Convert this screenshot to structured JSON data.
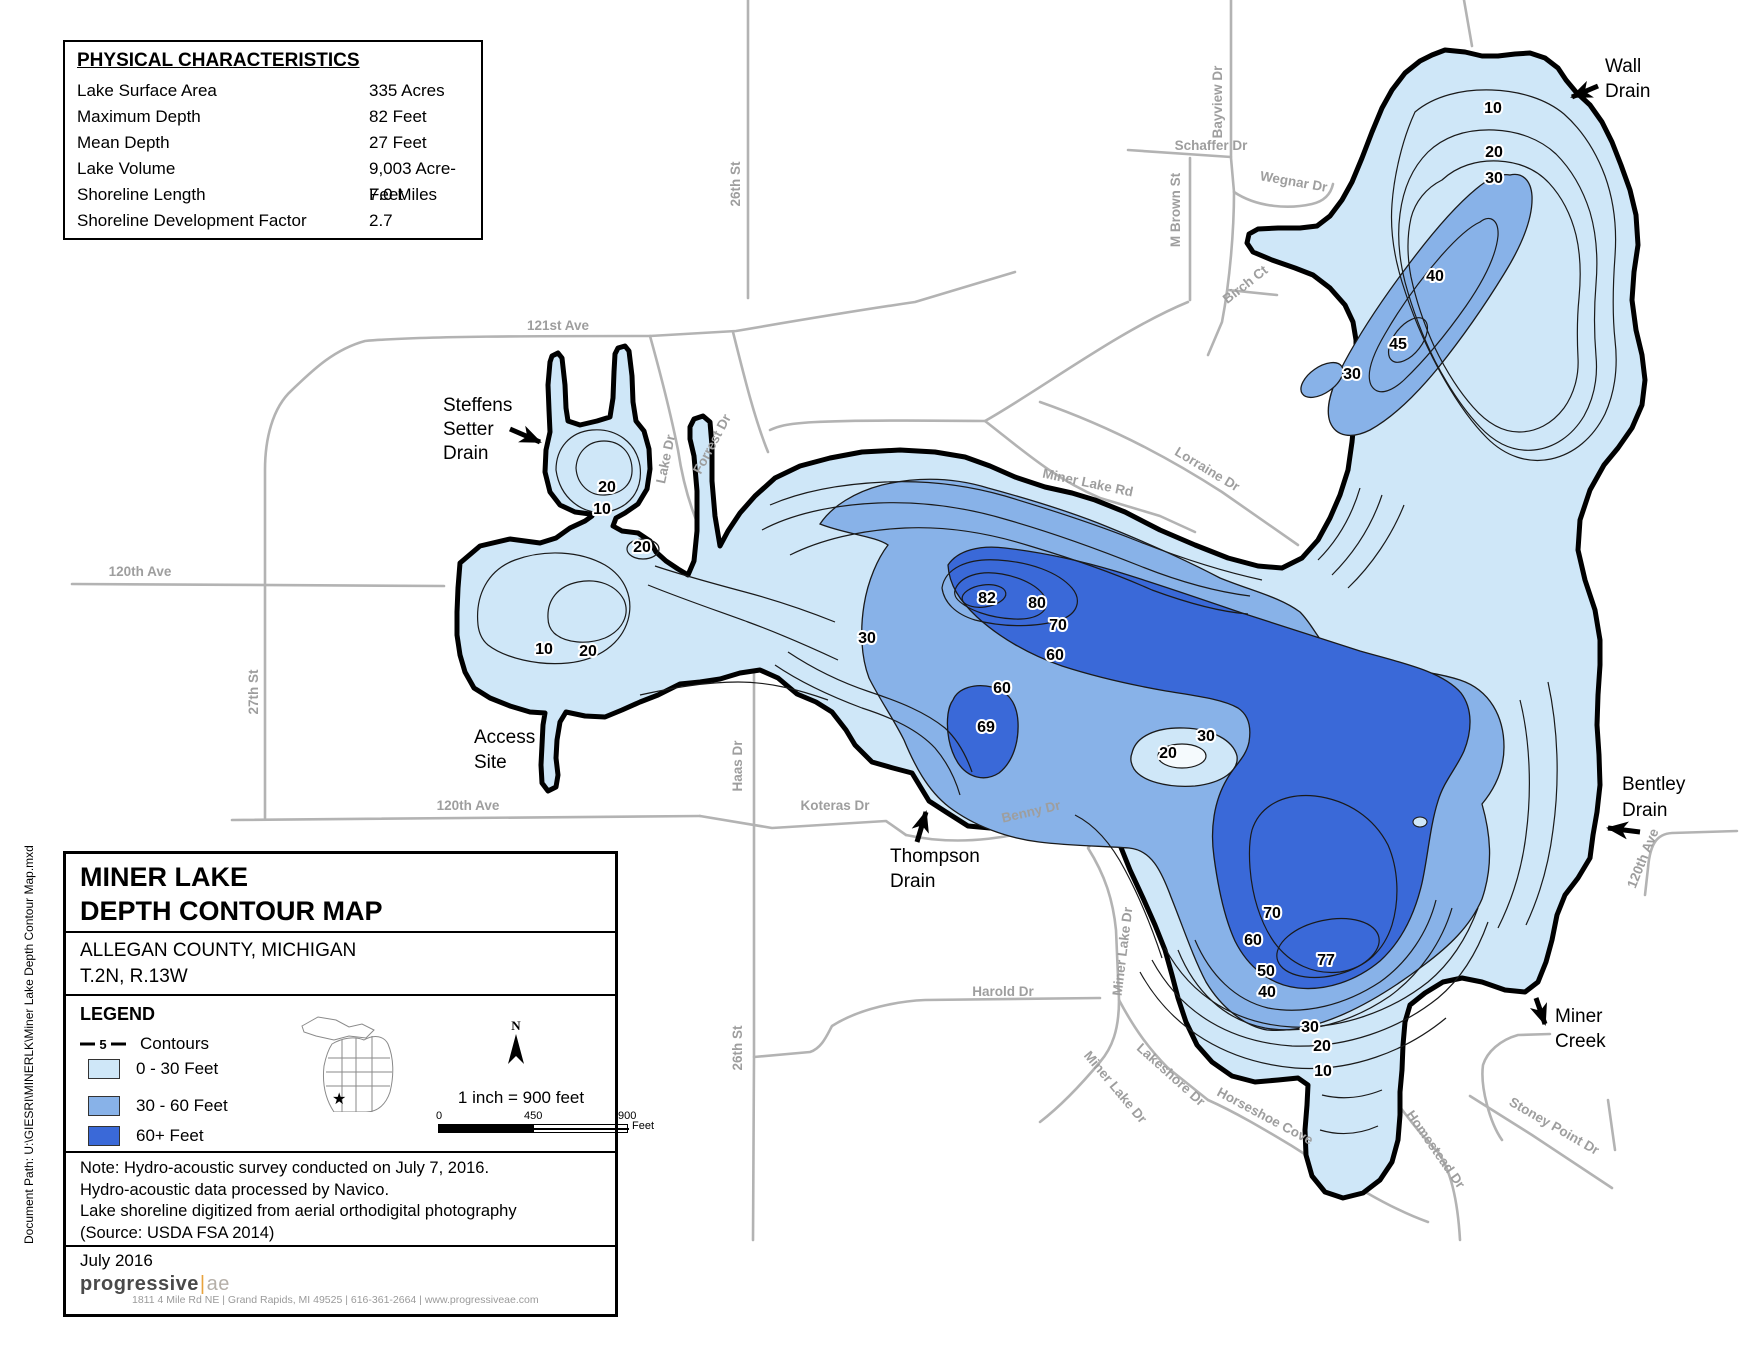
{
  "document_path": "Document Path: U:\\GIESRI\\MINERLK\\Miner Lake Depth Contour Map.mxd",
  "physical_characteristics": {
    "title": "PHYSICAL CHARACTERISTICS",
    "rows": [
      {
        "label": "Lake Surface Area",
        "value": "335 Acres"
      },
      {
        "label": "Maximum Depth",
        "value": "82 Feet"
      },
      {
        "label": "Mean Depth",
        "value": "27 Feet"
      },
      {
        "label": "Lake Volume",
        "value": "9,003 Acre-Feet"
      },
      {
        "label": "Shoreline Length",
        "value": "7.0 Miles"
      },
      {
        "label": "Shoreline Development Factor",
        "value": "2.7"
      }
    ]
  },
  "title_block": {
    "title_line1": "MINER LAKE",
    "title_line2": "DEPTH CONTOUR MAP",
    "subtitle_line1": "ALLEGAN COUNTY, MICHIGAN",
    "subtitle_line2": "T.2N, R.13W"
  },
  "legend": {
    "heading": "LEGEND",
    "contours_label": "Contours",
    "contour_symbol_value": "5",
    "classes": [
      {
        "label": "0 - 30 Feet",
        "color": "#cfe7f8"
      },
      {
        "label": "30 - 60 Feet",
        "color": "#88b2e8"
      },
      {
        "label": "60+ Feet",
        "color": "#3a69d8"
      }
    ],
    "north_label": "N",
    "scale_text": "1 inch = 900 feet",
    "scale_ticks": [
      "0",
      "450",
      "900"
    ],
    "scale_unit": "Feet"
  },
  "notes": {
    "lines": [
      "Note: Hydro-acoustic survey conducted on July 7, 2016.",
      "Hydro-acoustic data processed by Navico.",
      "Lake shoreline digitized from aerial orthodigital photography",
      "(Source: USDA FSA 2014)"
    ]
  },
  "footer": {
    "date": "July 2016",
    "logo_text": "progressive",
    "logo_suffix": "ae",
    "address": "1811 4 Mile Rd NE  |  Grand Rapids, MI 49525  |  616-361-2664  |  www.progressiveae.com"
  },
  "map": {
    "road_labels": {
      "st26_top": "26th St",
      "ave121": "121st Ave",
      "lake_dr": "Lake Dr",
      "forrest_dr": "Forrest Dr",
      "ave120_left": "120th Ave",
      "st27": "27th St",
      "ave120_bottom": "120th Ave",
      "koteras": "Koteras Dr",
      "benny": "Benny Dr",
      "haas": "Haas Dr",
      "st26_bottom": "26th St",
      "harold": "Harold Dr",
      "miner_lake_rd": "Miner Lake Rd",
      "lorraine": "Lorraine Dr",
      "bayview": "Bayview Dr",
      "schaffer": "Schaffer Dr",
      "mbrown": "M Brown St",
      "wegnar": "Wegnar Dr",
      "birch": "Birch Ct",
      "miner_lake_dr_upper": "Miner Lake Dr",
      "lakeshore": "Lakeshore Dr",
      "miner_lake_dr_lower": "Miner Lake Dr",
      "horseshoe": "Horseshoe Cove",
      "homestead": "Homestead Dr",
      "stoney": "Stoney Point Dr",
      "ave120_right": "120th Ave"
    },
    "annotations": {
      "wall_drain_1": "Wall",
      "wall_drain_2": "Drain",
      "steffens_1": "Steffens",
      "steffens_2": "Setter",
      "steffens_3": "Drain",
      "access_1": "Access",
      "access_2": "Site",
      "thompson_1": "Thompson",
      "thompson_2": "Drain",
      "bentley_1": "Bentley",
      "bentley_2": "Drain",
      "miner_creek_1": "Miner",
      "miner_creek_2": "Creek"
    },
    "depth_labels": [
      "10",
      "20",
      "30",
      "40",
      "45",
      "30",
      "20",
      "10",
      "20",
      "10",
      "20",
      "30",
      "82",
      "80",
      "70",
      "60",
      "60",
      "69",
      "20",
      "30",
      "70",
      "60",
      "50",
      "77",
      "40",
      "30",
      "20",
      "10"
    ],
    "colors": {
      "depth_0_30": "#cfe7f8",
      "depth_30_60": "#88b2e8",
      "depth_60_plus": "#3a69d8",
      "shoreline": "#000000",
      "road": "#b3b3b3"
    }
  }
}
